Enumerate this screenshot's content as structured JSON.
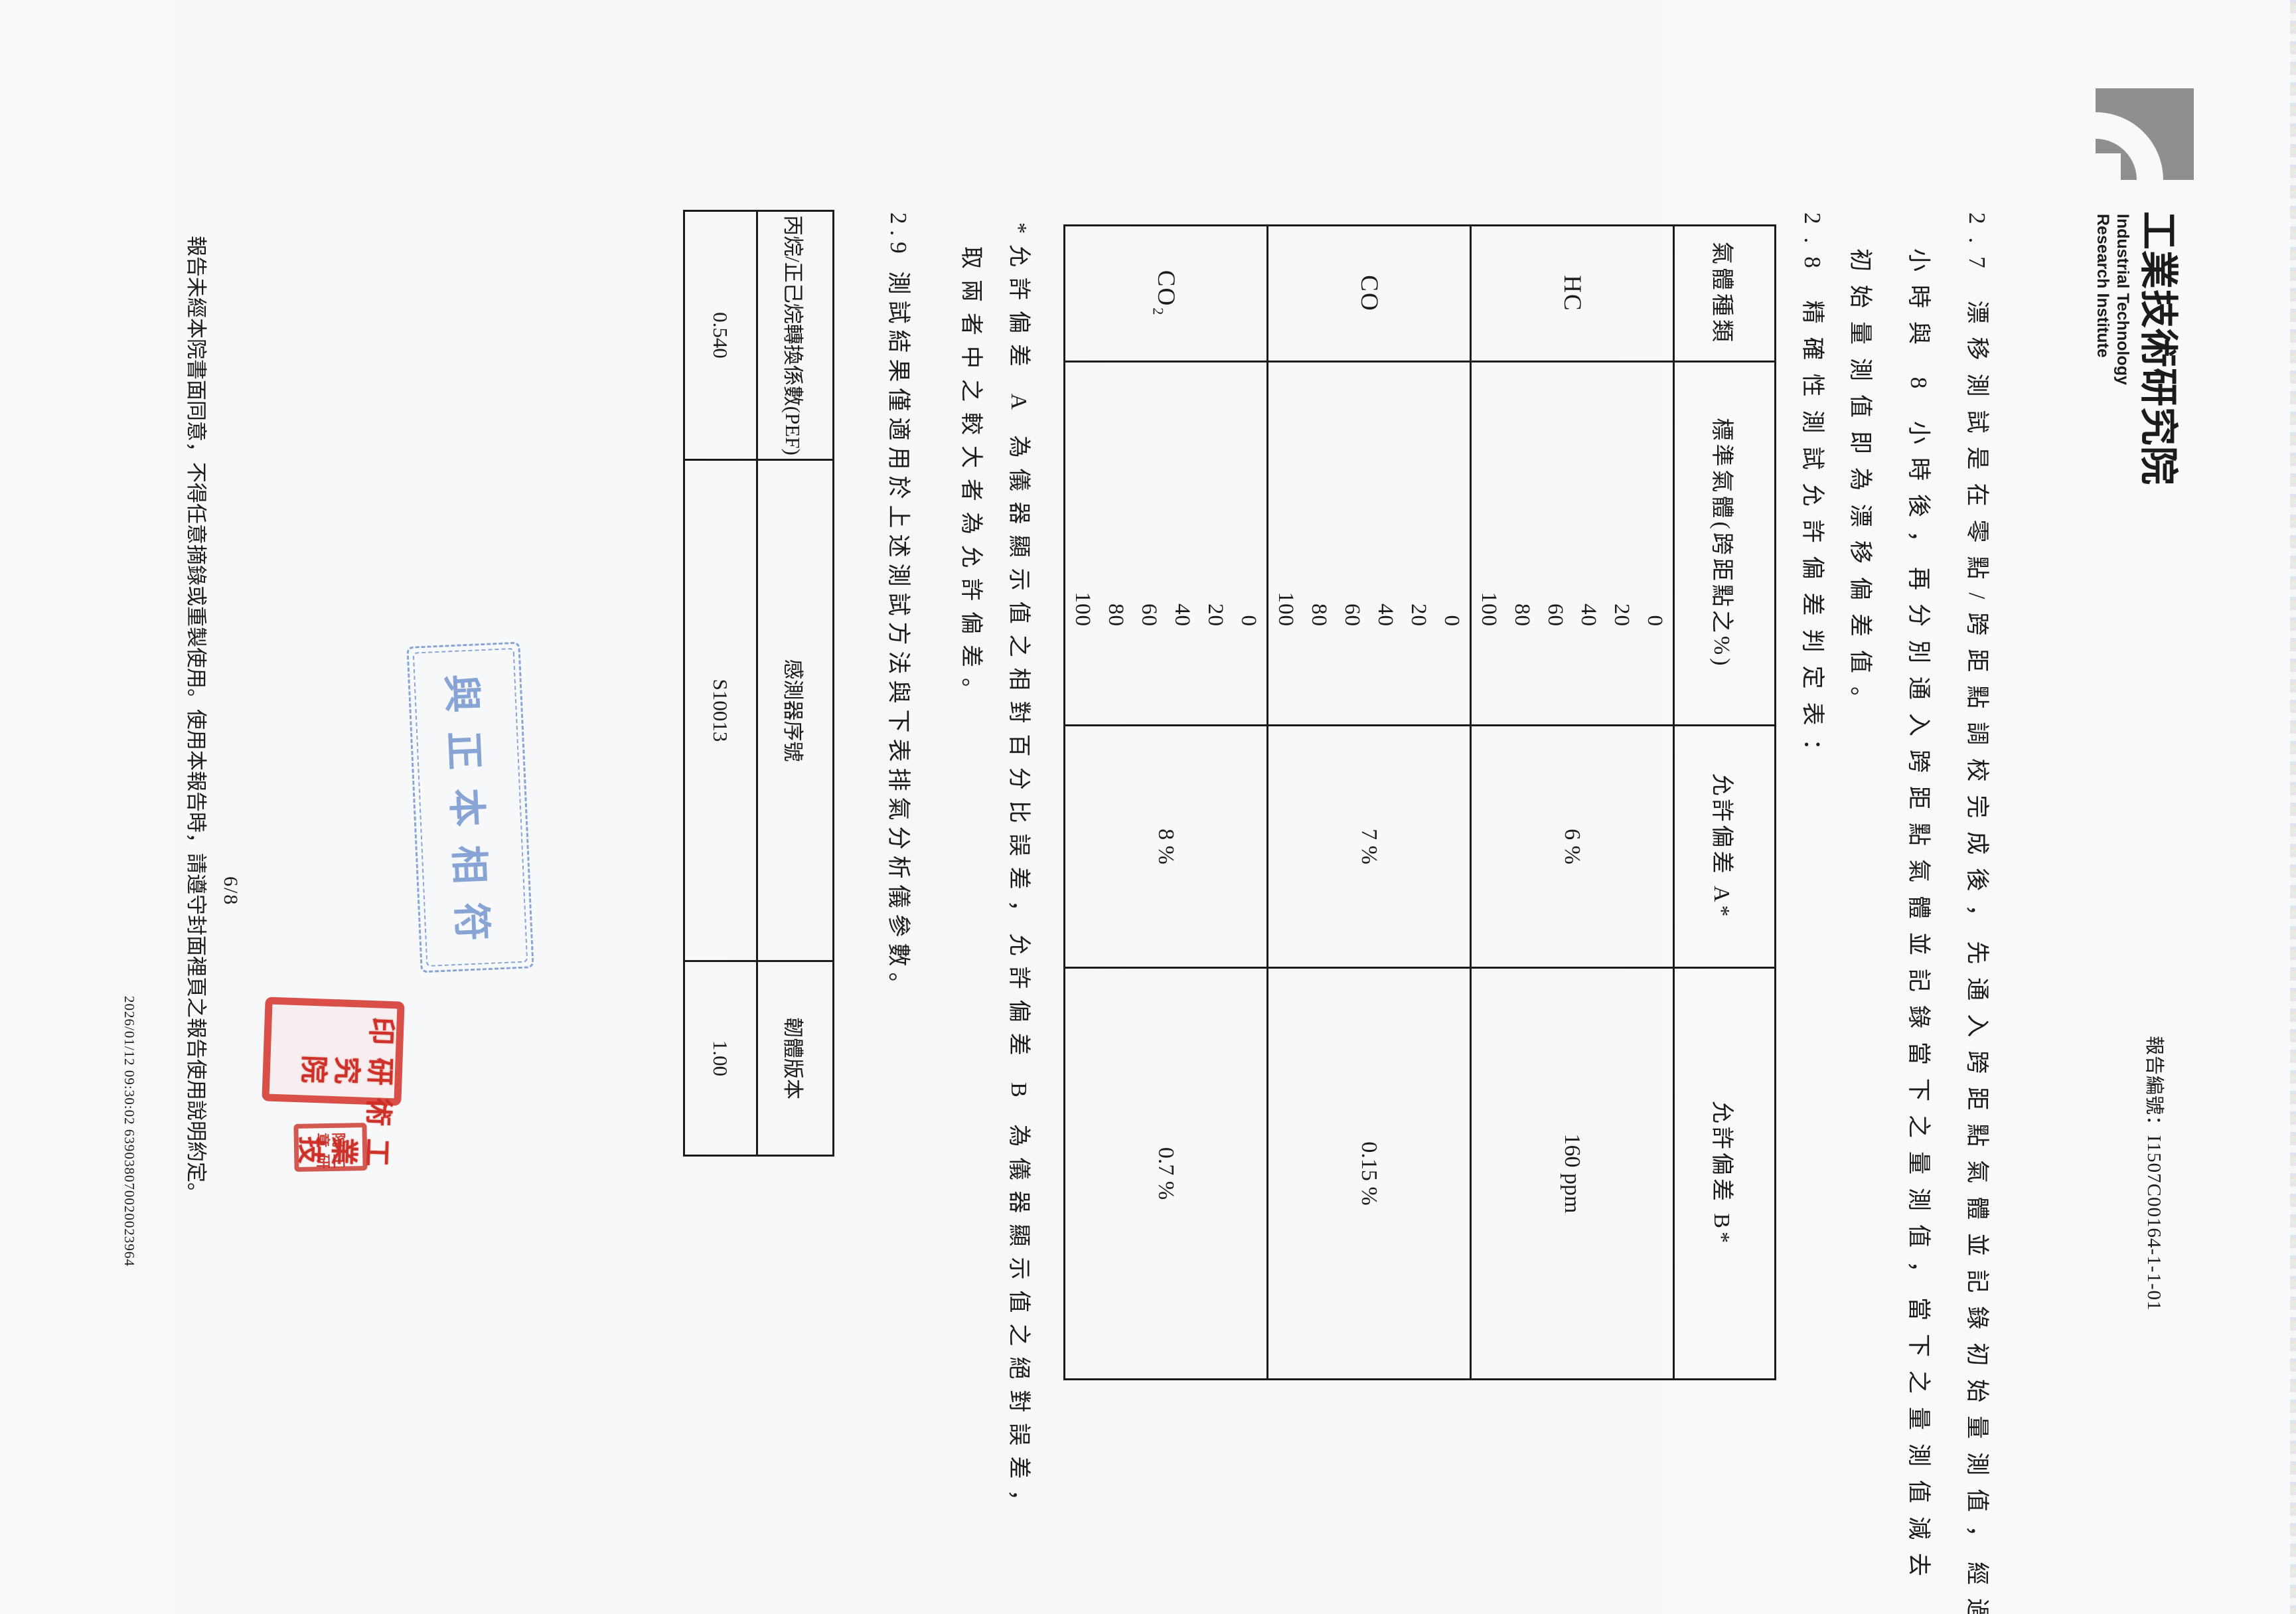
{
  "header": {
    "institute_zh": "工業技術研究院",
    "institute_en_line1": "Industrial Technology",
    "institute_en_line2": "Research Institute",
    "report_no_line": "報告編號：I1507C00164-1-1-01"
  },
  "sections": {
    "s27_line1": "2.7 漂移測試是在零點/跨距點調校完成後，先通入跨距點氣體並記錄初始量測值，經過 4",
    "s27_line2": "小時與 8 小時後，再分別通入跨距點氣體並記錄當下之量測值，當下之量測值減去",
    "s27_line3": "初始量測值即為漂移偏差值。",
    "s28_heading": "2.8 精確性測試允許偏差判定表：",
    "s29_heading": "2.9 測試結果僅適用於上述測試方法與下表排氣分析儀參數。"
  },
  "tolerance_table": {
    "headers": [
      "氣體種類",
      "標準氣體(跨距點之%)",
      "允許偏差 A*",
      "允許偏差 B*"
    ],
    "rows": [
      {
        "gas": "HC",
        "standards": [
          "0",
          "20",
          "40",
          "60",
          "80",
          "100"
        ],
        "a": "6 %",
        "b": "160 ppm"
      },
      {
        "gas": "CO",
        "standards": [
          "0",
          "20",
          "40",
          "60",
          "80",
          "100"
        ],
        "a": "7 %",
        "b": "0.15 %"
      },
      {
        "gas": "CO₂",
        "standards": [
          "0",
          "20",
          "40",
          "60",
          "80",
          "100"
        ],
        "a": "8 %",
        "b": "0.7 %"
      }
    ]
  },
  "footnote": {
    "line1": "*允許偏差 A 為儀器顯示值之相對百分比誤差，允許偏差 B 為儀器顯示值之絕對誤差，",
    "line2": "取兩者中之較大者為允許偏差。"
  },
  "analyzer_table": {
    "headers": [
      "丙烷/正己烷轉換係數(PEF)",
      "感測器序號",
      "韌體版本"
    ],
    "values": [
      "0.540",
      "S10013",
      "1.00"
    ]
  },
  "stamps": {
    "copy_stamp_text": "與正本相符",
    "seal_large_col_right": "工業技術",
    "seal_large_col_left": "研究院印",
    "seal_small_col_right": "工研",
    "seal_small_col_left": "院章"
  },
  "footer": {
    "page_number": "6/8",
    "notice": "報告未經本院書面同意，不得任意摘錄或重製使用。使用本報告時，請遵守封面裡頁之報告使用說明約定。",
    "datetime_serial": "2026/01/12 09:30:02 639038070020023964"
  }
}
